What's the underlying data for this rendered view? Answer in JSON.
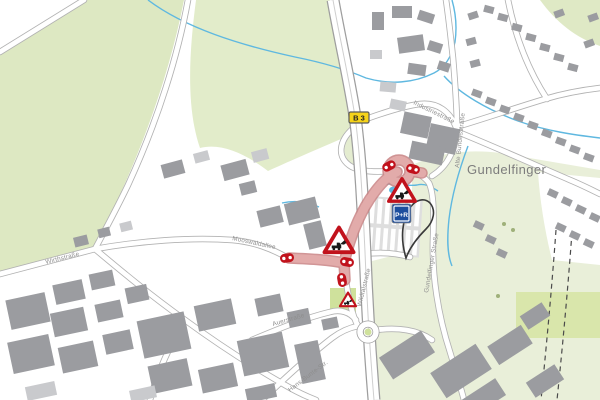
{
  "map": {
    "place_labels": {
      "town": "Gundelfinger"
    },
    "street_labels": [
      {
        "id": "wirthstrasse",
        "text": "Wirthstraße"
      },
      {
        "id": "mooswaldallee",
        "text": "Mooswaldallee"
      },
      {
        "id": "industriestrasse",
        "text": "Industriestraße"
      },
      {
        "id": "alte-bundesstrasse",
        "text": "Alte Bundesstraße"
      },
      {
        "id": "gundelfinger-strasse",
        "text": "Gundelfinger Straße"
      },
      {
        "id": "wildtalstrasse",
        "text": "Wildtalstraße"
      },
      {
        "id": "auerstrasse",
        "text": "Auerstraße"
      },
      {
        "id": "hans-bunte-str",
        "text": "Hans-Bunte-Str."
      }
    ],
    "badges": {
      "road_number": "B 3",
      "park_and_ride": "P+R"
    },
    "map_icons": [
      "roadworks-sign-icon",
      "road-closure-marker-icon",
      "route-badge-b3",
      "park-and-ride-sign",
      "bus-loop-route"
    ],
    "colors": {
      "field_green": "#dde8c2",
      "field_green_light": "#e9efd9",
      "field_green_bright": "#d4e3a3",
      "building_gray": "#9b9ca0",
      "building_light": "#c9cacd",
      "water_blue": "#5fb8e0",
      "construction_pink": "#e2abaa",
      "construction_edge": "#c98384",
      "sign_red": "#c1121c",
      "badge_yellow": "#f6d319",
      "pr_blue": "#1d4e9e",
      "road_casing": "#b2b2b2"
    }
  }
}
